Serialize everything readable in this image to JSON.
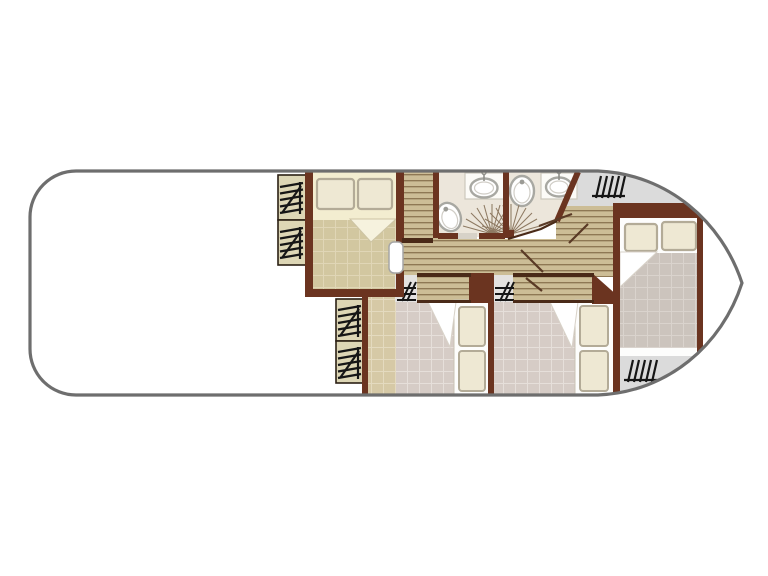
{
  "document": {
    "kind": "boat-floor-plan",
    "visible_text": []
  },
  "colors": {
    "hull_line": "#6e6e6e",
    "wall": "#6b3420",
    "wall_dark": "#4a2a18",
    "planks": "#ccbd96",
    "plank_line": "#8a7550",
    "tan": "#d6c9a6",
    "tan_line": "#e4dabf",
    "mauve": "#d6ccc6",
    "mauve_line": "#e6dfda",
    "graygrid": "#ccc4bd",
    "graygrid_line": "#dad3cd",
    "khaki": "#d2c7a0",
    "khaki_line": "#e0d6b6",
    "bath": "#ece6db",
    "deck": "#dbdbdb",
    "pad": "#e4e2e0",
    "cream": "#f3edd0",
    "pillow": "#eee8d3",
    "pillow_line": "#b3ab97",
    "wardrobe": "#ddd6b5",
    "glyph": "#161616",
    "fixture_line": "#a8a8a2",
    "door_line": "#5a3a26",
    "white": "#ffffff"
  },
  "rooms": [
    {
      "name": "bow-deck"
    },
    {
      "name": "owner-cabin"
    },
    {
      "name": "wardrobe-column-forward"
    },
    {
      "name": "wardrobe-column-mid"
    },
    {
      "name": "corridor"
    },
    {
      "name": "bathroom-port"
    },
    {
      "name": "bathroom-starboard"
    },
    {
      "name": "guest-cabin-port"
    },
    {
      "name": "guest-cabin-starboard"
    },
    {
      "name": "aft-cabin"
    },
    {
      "name": "aft-deck-top"
    },
    {
      "name": "aft-deck-bottom"
    }
  ],
  "furniture_counts": {
    "double_beds": 2,
    "single_berths": 2,
    "pillows": 8,
    "toilets": 2,
    "sinks": 2,
    "shower_spray_symbols": 2,
    "stair_symbols": 8,
    "wardrobe_cells": 4,
    "door_leaves": 5
  },
  "icons": [
    {
      "name": "stairs-icon",
      "style": "hatched ladder tally, black"
    },
    {
      "name": "shower-spray-icon",
      "style": "fan of radiating lines"
    },
    {
      "name": "toilet-icon",
      "style": "double-outline oval with dot"
    },
    {
      "name": "sink-icon",
      "style": "oval basin with tap"
    },
    {
      "name": "door-leaf-icon",
      "style": "white rounded slab / brown swing line"
    }
  ]
}
